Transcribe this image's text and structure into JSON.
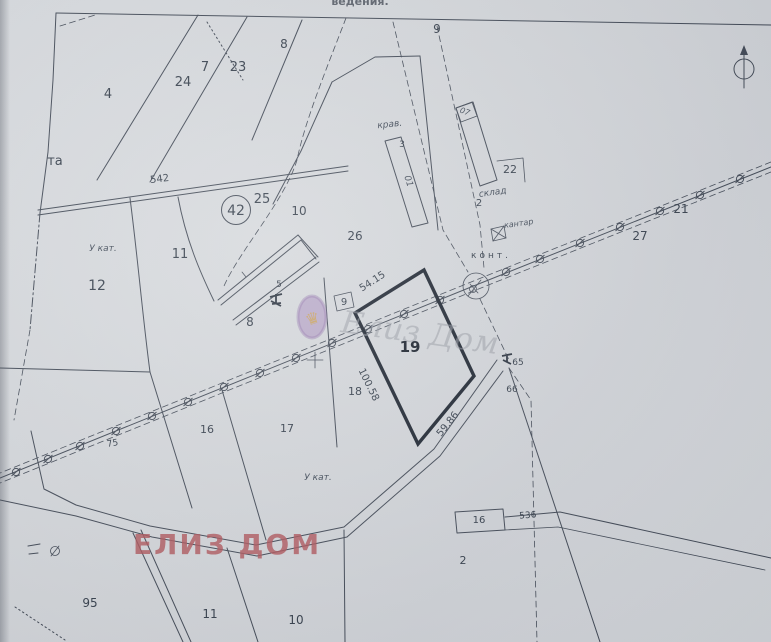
{
  "header_fragment": {
    "text": "ведения."
  },
  "overlay": {
    "text": "ЕЛИЗ ДОМ",
    "color": "#ad5157"
  },
  "watermark": {
    "script_text": "Елиз Дом",
    "emblem_glyph": "♛",
    "oval_color": "#9b7cb5",
    "gold_color": "#c99f55"
  },
  "highlight_parcel": {
    "number": "19",
    "sides_m": [
      "54.15",
      "100.58",
      "59.86"
    ]
  },
  "north_symbol": "north-arrow",
  "labels": [
    {
      "t": "4",
      "x": 108,
      "y": 98,
      "s": 13
    },
    {
      "t": "24",
      "x": 183,
      "y": 86,
      "s": 13
    },
    {
      "t": "7",
      "x": 205,
      "y": 71,
      "s": 13
    },
    {
      "t": "23",
      "x": 238,
      "y": 71,
      "s": 13
    },
    {
      "t": "8",
      "x": 284,
      "y": 48,
      "s": 12
    },
    {
      "t": "9",
      "x": 437,
      "y": 33,
      "s": 12
    },
    {
      "t": "та",
      "x": 55,
      "y": 165,
      "s": 13
    },
    {
      "t": "542",
      "x": 160,
      "y": 182,
      "s": 10,
      "r": -7
    },
    {
      "t": "42",
      "x": 236,
      "y": 215,
      "s": 14
    },
    {
      "t": "25",
      "x": 262,
      "y": 203,
      "s": 13
    },
    {
      "t": "10",
      "x": 299,
      "y": 215,
      "s": 12
    },
    {
      "t": "26",
      "x": 355,
      "y": 240,
      "s": 12
    },
    {
      "t": "11",
      "x": 180,
      "y": 258,
      "s": 13
    },
    {
      "t": "У кат.",
      "x": 103,
      "y": 251,
      "s": 9,
      "c": "it"
    },
    {
      "t": "12",
      "x": 97,
      "y": 290,
      "s": 14
    },
    {
      "t": "8",
      "x": 250,
      "y": 326,
      "s": 12
    },
    {
      "t": "5",
      "x": 279,
      "y": 287,
      "s": 9
    },
    {
      "t": "9",
      "x": 344,
      "y": 305,
      "s": 10
    },
    {
      "t": "крав.",
      "x": 390,
      "y": 127,
      "s": 9,
      "c": "it",
      "r": -6
    },
    {
      "t": "3",
      "x": 402,
      "y": 147,
      "s": 9
    },
    {
      "t": "01",
      "x": 406,
      "y": 182,
      "s": 9,
      "c": "it",
      "r": 72
    },
    {
      "t": "07",
      "x": 464,
      "y": 114,
      "s": 8,
      "c": "it",
      "r": 20
    },
    {
      "t": "склад",
      "x": 493,
      "y": 195,
      "s": 9,
      "c": "it",
      "r": -8
    },
    {
      "t": "2",
      "x": 479,
      "y": 206,
      "s": 10
    },
    {
      "t": "22",
      "x": 510,
      "y": 173,
      "s": 11
    },
    {
      "t": "кантар",
      "x": 519,
      "y": 226,
      "s": 8,
      "c": "it",
      "r": -8
    },
    {
      "t": "конт.",
      "x": 491,
      "y": 258,
      "s": 9,
      "c": "ls"
    },
    {
      "t": "21",
      "x": 681,
      "y": 213,
      "s": 12
    },
    {
      "t": "27",
      "x": 640,
      "y": 240,
      "s": 12
    },
    {
      "t": "65",
      "x": 518,
      "y": 365,
      "s": 9
    },
    {
      "t": "66",
      "x": 512,
      "y": 392,
      "s": 9
    },
    {
      "t": "75",
      "x": 113,
      "y": 446,
      "s": 9,
      "r": -10
    },
    {
      "t": "16",
      "x": 207,
      "y": 433,
      "s": 11
    },
    {
      "t": "17",
      "x": 287,
      "y": 432,
      "s": 11
    },
    {
      "t": "18",
      "x": 355,
      "y": 395,
      "s": 11
    },
    {
      "t": "У кат.",
      "x": 318,
      "y": 480,
      "s": 9,
      "c": "it"
    },
    {
      "t": "2",
      "x": 463,
      "y": 564,
      "s": 11
    },
    {
      "t": "16",
      "x": 479,
      "y": 523,
      "s": 10
    },
    {
      "t": "536",
      "x": 528,
      "y": 518,
      "s": 9,
      "r": -4
    },
    {
      "t": "95",
      "x": 90,
      "y": 607,
      "s": 12
    },
    {
      "t": "11",
      "x": 210,
      "y": 618,
      "s": 12
    },
    {
      "t": "10",
      "x": 296,
      "y": 624,
      "s": 12
    },
    {
      "t": "19",
      "x": 410,
      "y": 352,
      "s": 15,
      "c": "b"
    },
    {
      "t": "54.15",
      "x": 374,
      "y": 284,
      "s": 10,
      "r": -33
    },
    {
      "t": "100.58",
      "x": 366,
      "y": 386,
      "s": 10,
      "r": 64
    },
    {
      "t": "59.86",
      "x": 450,
      "y": 426,
      "s": 10,
      "r": -51
    }
  ]
}
